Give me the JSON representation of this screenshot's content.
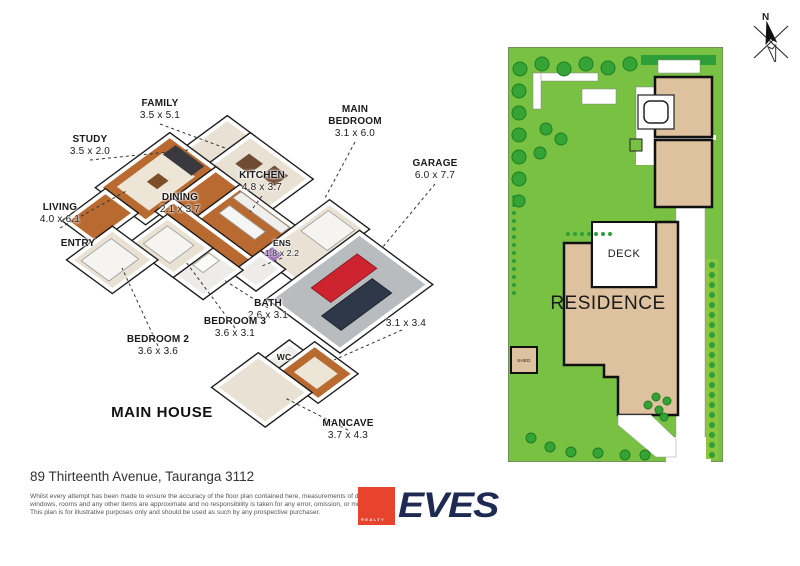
{
  "floor_plan": {
    "title": "MAIN HOUSE",
    "colors": {
      "wood": "#B96A30",
      "carpet": "#E9E2D4",
      "tile": "#EDECE8",
      "garage": "#B9BCBF",
      "wall": "#FFFFFF",
      "outline": "#1A1A1A",
      "leader": "#333333"
    },
    "projection": {
      "a": 11.5,
      "b": 8.5,
      "cx": 200,
      "cy": 106
    },
    "rooms": [
      {
        "id": "study",
        "floor": "carpet",
        "x0": 1.5,
        "y0": 0,
        "x1": 3.5,
        "y1": 3.5
      },
      {
        "id": "family",
        "floor": "carpet",
        "x0": 3.5,
        "y0": 0,
        "x1": 8.6,
        "y1": 3.5
      },
      {
        "id": "living",
        "floor": "wood",
        "x0": 0,
        "y0": 3.5,
        "x1": 4.0,
        "y1": 9.6
      },
      {
        "id": "dining",
        "floor": "wood",
        "x0": 4.0,
        "y0": 3.5,
        "x1": 6.1,
        "y1": 7.2
      },
      {
        "id": "kitchen",
        "floor": "wood",
        "x0": 6.1,
        "y0": 3.5,
        "x1": 10.9,
        "y1": 7.2
      },
      {
        "id": "hall",
        "floor": "wood",
        "x0": 4.0,
        "y0": 7.2,
        "x1": 10.9,
        "y1": 8.4
      },
      {
        "id": "mainbed",
        "floor": "carpet",
        "x0": 10.9,
        "y0": 0.5,
        "x1": 14.0,
        "y1": 6.5
      },
      {
        "id": "ens",
        "floor": "tile",
        "x0": 10.9,
        "y0": 6.5,
        "x1": 12.7,
        "y1": 8.7
      },
      {
        "id": "garage",
        "floor": "garage",
        "x0": 14.0,
        "y0": 1.0,
        "x1": 20.0,
        "y1": 8.7
      },
      {
        "id": "bath",
        "floor": "tile",
        "x0": 8.3,
        "y0": 8.4,
        "x1": 10.9,
        "y1": 11.5
      },
      {
        "id": "bed3",
        "floor": "carpet",
        "x0": 4.7,
        "y0": 8.4,
        "x1": 8.3,
        "y1": 11.5
      },
      {
        "id": "entry",
        "floor": "wood",
        "x0": 0.5,
        "y0": 9.6,
        "x1": 3.0,
        "y1": 13.0
      },
      {
        "id": "bed2",
        "floor": "carpet",
        "x0": 3.0,
        "y0": 11.5,
        "x1": 6.6,
        "y1": 15.1
      },
      {
        "id": "wc",
        "floor": "tile",
        "x0": 17.4,
        "y0": 10.5,
        "x1": 18.6,
        "y1": 12.6
      },
      {
        "id": "r3134",
        "floor": "wood",
        "x0": 18.6,
        "y0": 9.5,
        "x1": 22.0,
        "y1": 12.6
      },
      {
        "id": "mancave",
        "floor": "carpet",
        "x0": 16.8,
        "y0": 12.6,
        "x1": 21.1,
        "y1": 16.3
      }
    ],
    "furniture": [
      {
        "x0": 0.7,
        "y0": 4.8,
        "x1": 3.5,
        "y1": 8.8,
        "f": "#EDE6D6"
      },
      {
        "x0": 0.8,
        "y0": 3.8,
        "x1": 3.3,
        "y1": 4.9,
        "f": "#3A3A3E"
      },
      {
        "x0": 1.7,
        "y0": 6.2,
        "x1": 2.6,
        "y1": 7.2,
        "f": "#7D4E27"
      },
      {
        "x0": 4.5,
        "y0": 1.1,
        "x1": 5.7,
        "y1": 2.3,
        "f": "#6F4B34"
      },
      {
        "x0": 6.3,
        "y0": 0.7,
        "x1": 7.5,
        "y1": 1.9,
        "f": "#6F4B34"
      },
      {
        "x0": 6.7,
        "y0": 5.0,
        "x1": 9.8,
        "y1": 5.9,
        "f": "#F5F5F3",
        "s": "#999"
      },
      {
        "x0": 6.4,
        "y0": 3.7,
        "x1": 10.6,
        "y1": 4.4,
        "f": "#EFEFED",
        "s": "#999"
      },
      {
        "x0": 11.3,
        "y0": 1.0,
        "x1": 13.6,
        "y1": 3.4,
        "f": "#F6F4F0",
        "s": "#999"
      },
      {
        "x0": 11.0,
        "y0": 5.6,
        "x1": 11.9,
        "y1": 6.4,
        "f": "#9C6FB8"
      },
      {
        "x0": 5.2,
        "y0": 8.9,
        "x1": 7.5,
        "y1": 11.0,
        "f": "#F6F4F0",
        "s": "#999"
      },
      {
        "x0": 3.5,
        "y0": 12.1,
        "x1": 5.9,
        "y1": 14.7,
        "f": "#F6F4F0",
        "s": "#999"
      },
      {
        "x0": 19.3,
        "y0": 10.2,
        "x1": 21.3,
        "y1": 12.0,
        "f": "#EDE6D6"
      },
      {
        "x0": 8.6,
        "y0": 8.7,
        "x1": 9.5,
        "y1": 10.1,
        "f": "#FAFAF8",
        "s": "#999"
      },
      {
        "x0": 15.1,
        "y0": 2.3,
        "x1": 16.8,
        "y1": 6.3,
        "f": "#CE2430",
        "s": "#7E141C"
      },
      {
        "x0": 17.2,
        "y0": 3.1,
        "x1": 18.9,
        "y1": 7.5,
        "f": "#2F3848",
        "s": "#171D28"
      }
    ],
    "labels": [
      {
        "id": "family",
        "lines": [
          "FAMILY"
        ],
        "dims": "3.5 x 5.1",
        "x": 150,
        "y": 98,
        "leader": [
          150,
          124,
          215,
          148
        ]
      },
      {
        "id": "study",
        "lines": [
          "STUDY"
        ],
        "dims": "3.5 x 2.0",
        "x": 80,
        "y": 134,
        "leader": [
          80,
          160,
          178,
          150
        ]
      },
      {
        "id": "main-bedroom",
        "lines": [
          "MAIN",
          "BEDROOM"
        ],
        "dims": "3.1 x 6.0",
        "x": 345,
        "y": 104,
        "leader": [
          345,
          142,
          315,
          198
        ]
      },
      {
        "id": "garage",
        "lines": [
          "GARAGE"
        ],
        "dims": "6.0 x 7.7",
        "x": 425,
        "y": 158,
        "leader": [
          425,
          184,
          372,
          248
        ]
      },
      {
        "id": "kitchen",
        "lines": [
          "KITCHEN"
        ],
        "dims": "4.8 x 3.7",
        "x": 252,
        "y": 170,
        "leader": [
          252,
          196,
          240,
          212
        ]
      },
      {
        "id": "dining",
        "lines": [
          "DINING"
        ],
        "dims": "2.1 x 3.7",
        "x": 170,
        "y": 192
      },
      {
        "id": "living",
        "lines": [
          "LIVING"
        ],
        "dims": "4.0 x 6.1",
        "x": 50,
        "y": 202,
        "leader": [
          50,
          228,
          118,
          190
        ]
      },
      {
        "id": "ens",
        "lines": [
          "ENS"
        ],
        "dims": "1.8 x 2.2",
        "x": 272,
        "y": 238,
        "small": true,
        "leader": [
          272,
          258,
          252,
          266
        ]
      },
      {
        "id": "bath",
        "lines": [
          "BATH"
        ],
        "dims": "2.6 x 3.1",
        "x": 258,
        "y": 298,
        "leader": [
          258,
          308,
          214,
          280
        ]
      },
      {
        "id": "r3134",
        "lines": [],
        "dims": "3.1 x 3.4",
        "x": 396,
        "y": 318,
        "leader": [
          392,
          330,
          324,
          360
        ]
      },
      {
        "id": "wc",
        "lines": [
          "WC"
        ],
        "x": 274,
        "y": 352,
        "small": true
      },
      {
        "id": "entry",
        "lines": [
          "ENTRY"
        ],
        "x": 68,
        "y": 238
      },
      {
        "id": "bedroom3",
        "lines": [
          "BEDROOM 3"
        ],
        "dims": "3.6 x 3.1",
        "x": 225,
        "y": 316,
        "leader": [
          225,
          328,
          176,
          262
        ]
      },
      {
        "id": "bedroom2",
        "lines": [
          "BEDROOM 2"
        ],
        "dims": "3.6 x 3.6",
        "x": 148,
        "y": 334,
        "leader": [
          148,
          346,
          112,
          268
        ]
      },
      {
        "id": "mancave",
        "lines": [
          "MANCAVE"
        ],
        "dims": "3.7 x 4.3",
        "x": 338,
        "y": 418,
        "leader": [
          338,
          430,
          275,
          398
        ]
      }
    ],
    "title_pos": {
      "x": 152,
      "y": 404
    }
  },
  "site_plan": {
    "colors": {
      "lawn": "#79C143",
      "tree": "#35A336",
      "tree_edge": "#1E7D20",
      "hedge": "#8CC63F",
      "dark_green": "#2E9E38",
      "building": "#DEC19E",
      "outline": "#111111",
      "path": "#FFFFFF"
    },
    "shapes": [
      {
        "t": "r",
        "x": 0,
        "y": 0,
        "w": 215,
        "h": 415,
        "f": "#79C143",
        "s": "#666",
        "sw": 1
      },
      {
        "t": "r",
        "x": 133,
        "y": 8,
        "w": 75,
        "h": 10,
        "f": "#2E9E38"
      },
      {
        "t": "r",
        "x": 25,
        "y": 26,
        "w": 65,
        "h": 8,
        "f": "#fff",
        "s": "#888",
        "sw": 0.5
      },
      {
        "t": "r",
        "x": 25,
        "y": 26,
        "w": 8,
        "h": 36,
        "f": "#fff",
        "s": "#888",
        "sw": 0.5
      },
      {
        "t": "r",
        "x": 74,
        "y": 42,
        "w": 34,
        "h": 15,
        "f": "#fff",
        "s": "#888",
        "sw": 0.5
      },
      {
        "t": "r",
        "x": 150,
        "y": 13,
        "w": 42,
        "h": 13,
        "f": "#fff",
        "s": "#888",
        "sw": 0.5
      },
      {
        "t": "r",
        "x": 128,
        "y": 40,
        "w": 28,
        "h": 78,
        "f": "#fff",
        "s": "#888",
        "sw": 0.5
      },
      {
        "t": "r",
        "x": 128,
        "y": 100,
        "w": 48,
        "h": 18,
        "f": "#fff"
      },
      {
        "t": "r",
        "x": 140,
        "y": 103,
        "w": 47,
        "h": 15,
        "f": "#fff"
      },
      {
        "t": "r",
        "x": 145,
        "y": 88,
        "w": 63,
        "h": 5,
        "f": "#fff"
      },
      {
        "t": "r",
        "x": 168,
        "y": 118,
        "w": 29,
        "h": 292,
        "f": "#fff",
        "s": "#999",
        "sw": 0.5
      },
      {
        "t": "r",
        "x": 158,
        "y": 390,
        "w": 45,
        "h": 25,
        "f": "#fff"
      },
      {
        "t": "r",
        "x": 198,
        "y": 212,
        "w": 12,
        "h": 200,
        "f": "#8CC63F"
      },
      {
        "t": "dots",
        "x": 204,
        "y": 218,
        "dx": 0,
        "dy": 10,
        "n": 20,
        "r": 3,
        "f": "#2E9E38"
      },
      {
        "t": "r",
        "x": 147,
        "y": 30,
        "w": 57,
        "h": 60,
        "f": "#DEC19E",
        "s": "#111",
        "sw": 2.5
      },
      {
        "t": "r",
        "x": 147,
        "y": 93,
        "w": 57,
        "h": 67,
        "f": "#DEC19E",
        "s": "#111",
        "sw": 2.5
      },
      {
        "t": "r",
        "x": 130,
        "y": 48,
        "w": 36,
        "h": 34,
        "f": "#fff",
        "s": "#222",
        "sw": 1.2
      },
      {
        "t": "rr",
        "x": 136,
        "y": 54,
        "w": 24,
        "h": 22,
        "rx": 6,
        "f": "#fff",
        "s": "#222",
        "sw": 1.5
      },
      {
        "t": "p",
        "pts": [
          [
            56,
            196
          ],
          [
            84,
            196
          ],
          [
            84,
            240
          ],
          [
            148,
            240
          ],
          [
            148,
            175
          ],
          [
            170,
            175
          ],
          [
            170,
            368
          ],
          [
            110,
            368
          ],
          [
            110,
            330
          ],
          [
            96,
            330
          ],
          [
            96,
            318
          ],
          [
            56,
            318
          ]
        ],
        "f": "#DEC19E",
        "s": "#111",
        "sw": 2.5
      },
      {
        "t": "r",
        "x": 84,
        "y": 175,
        "w": 64,
        "h": 65,
        "f": "#fff",
        "s": "#111",
        "sw": 2
      },
      {
        "t": "p",
        "pts": [
          [
            110,
            368
          ],
          [
            143,
            368
          ],
          [
            168,
            392
          ],
          [
            168,
            410
          ],
          [
            148,
            410
          ],
          [
            110,
            378
          ]
        ],
        "f": "#fff",
        "s": "#999",
        "sw": 0.5
      },
      {
        "t": "r",
        "x": 3,
        "y": 300,
        "w": 26,
        "h": 26,
        "f": "#DEC19E",
        "s": "#111",
        "sw": 2
      },
      {
        "t": "r",
        "x": 122,
        "y": 92,
        "w": 12,
        "h": 12,
        "f": "#79C143",
        "s": "#222",
        "sw": 1
      },
      {
        "t": "dots",
        "x": 60,
        "y": 187,
        "dx": 7,
        "dy": 0,
        "n": 7,
        "r": 2,
        "f": "#2E9E38"
      },
      {
        "t": "dots",
        "x": 6,
        "y": 150,
        "dx": 0,
        "dy": 8,
        "n": 13,
        "r": 2,
        "f": "#2E9E38"
      },
      {
        "t": "c",
        "x": 12,
        "y": 22,
        "r": 7
      },
      {
        "t": "c",
        "x": 34,
        "y": 17,
        "r": 7
      },
      {
        "t": "c",
        "x": 56,
        "y": 22,
        "r": 7
      },
      {
        "t": "c",
        "x": 78,
        "y": 17,
        "r": 7
      },
      {
        "t": "c",
        "x": 100,
        "y": 21,
        "r": 7
      },
      {
        "t": "c",
        "x": 122,
        "y": 17,
        "r": 7
      },
      {
        "t": "c",
        "x": 11,
        "y": 44,
        "r": 7
      },
      {
        "t": "c",
        "x": 11,
        "y": 66,
        "r": 7
      },
      {
        "t": "c",
        "x": 11,
        "y": 88,
        "r": 7
      },
      {
        "t": "c",
        "x": 11,
        "y": 110,
        "r": 7
      },
      {
        "t": "c",
        "x": 11,
        "y": 132,
        "r": 7
      },
      {
        "t": "c",
        "x": 11,
        "y": 154,
        "r": 6
      },
      {
        "t": "c",
        "x": 38,
        "y": 82,
        "r": 6
      },
      {
        "t": "c",
        "x": 53,
        "y": 92,
        "r": 6
      },
      {
        "t": "c",
        "x": 32,
        "y": 106,
        "r": 6
      },
      {
        "t": "c",
        "x": 23,
        "y": 391,
        "r": 5
      },
      {
        "t": "c",
        "x": 42,
        "y": 400,
        "r": 5
      },
      {
        "t": "c",
        "x": 63,
        "y": 405,
        "r": 5
      },
      {
        "t": "c",
        "x": 90,
        "y": 406,
        "r": 5
      },
      {
        "t": "c",
        "x": 117,
        "y": 408,
        "r": 5
      },
      {
        "t": "c",
        "x": 137,
        "y": 408,
        "r": 5
      },
      {
        "t": "c",
        "x": 140,
        "y": 358,
        "r": 4
      },
      {
        "t": "c",
        "x": 151,
        "y": 363,
        "r": 4
      },
      {
        "t": "c",
        "x": 159,
        "y": 354,
        "r": 4
      },
      {
        "t": "c",
        "x": 148,
        "y": 350,
        "r": 4
      },
      {
        "t": "c",
        "x": 156,
        "y": 370,
        "r": 4
      }
    ],
    "labels": [
      {
        "id": "deck-label",
        "text": "DECK",
        "x": 116,
        "y": 210,
        "size": 11,
        "ls": 0.5
      },
      {
        "id": "residence-label",
        "text": "RESIDENCE",
        "x": 100,
        "y": 262,
        "size": 19,
        "ls": 0.5
      },
      {
        "id": "shed-label",
        "text": "SHED",
        "x": 16,
        "y": 315,
        "size": 4.5,
        "ls": 0.3
      }
    ]
  },
  "north": {
    "label": "N"
  },
  "footer": {
    "address": "89 Thirteenth Avenue, Tauranga 3112",
    "disclaimer_lines": [
      "Whilst every attempt has been made to ensure the accuracy of the floor plan contained here, measurements of doors,",
      "windows, rooms and any other items are approximate and no responsibility is taken for any error, omission, or misstatement.",
      "This plan is for illustrative purposes only and should be used as such by any prospective purchaser."
    ],
    "logo": {
      "word": "EVES",
      "sub": "REALTY"
    }
  }
}
